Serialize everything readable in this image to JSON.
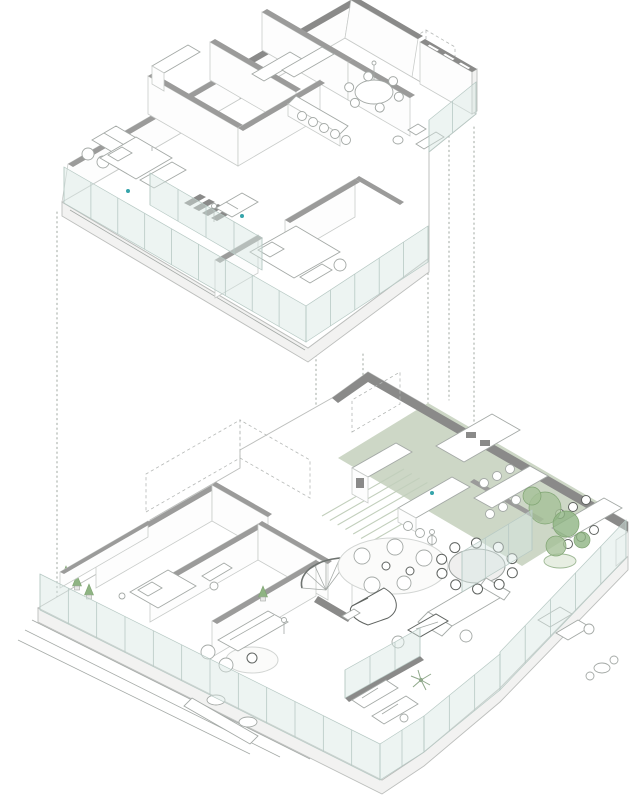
{
  "diagram": {
    "type": "exploded-axonometric-floor-plans",
    "floor_count": 2,
    "floors": [
      {
        "id": "upper-floor",
        "contents": [
          "bedroom with sofa and bed",
          "second bedroom",
          "master bedroom with bench",
          "bathroom",
          "kitchen with bar counter and five stools",
          "round dining table with chairs",
          "wardrobe cabinets",
          "stair opening with dark treads",
          "window-bay parapet wall",
          "perimeter glass walls"
        ]
      },
      {
        "id": "lower-floor",
        "contents": [
          "green roof strip with pergola slats",
          "kitchen with tall cabinets and island",
          "two long dining tables with chairs",
          "large round dining table with ten chairs",
          "winter-garden trees in planter",
          "lounge with round rug and armchairs",
          "grand piano",
          "curved staircase",
          "main sofa with dark coffee table",
          "left-wing bedroom",
          "left-wing living room",
          "terrace with sun loungers and palm",
          "terrace bar counter with round tables",
          "potted plants",
          "glass balustrades",
          "perimeter steps"
        ]
      }
    ]
  },
  "colors": {
    "bg": "#ffffff",
    "line": "#bdbfbd",
    "furn": "#a4a9a6",
    "slab_side": "#f2f2f1",
    "wall_cap": "#9b9b9a",
    "wall_cap_dark": "#8a8a89",
    "glass": "#d8e6e2",
    "green_roof": "#cdd7c6",
    "plant": "#a5c197",
    "plant_dark": "#8fb483",
    "plant_edge": "#7fa472",
    "accent_teal": "#35a4aa",
    "dotted_line": "#a0a8a2"
  },
  "projection_lines": [
    {
      "x": 57,
      "y1": 212,
      "y2": 597
    },
    {
      "x": 316,
      "y1": 350,
      "y2": 455
    },
    {
      "x": 363,
      "y1": 354,
      "y2": 446
    },
    {
      "x": 428,
      "y1": 206,
      "y2": 448
    },
    {
      "x": 449,
      "y1": 131,
      "y2": 400
    },
    {
      "x": 474,
      "y1": 127,
      "y2": 560
    }
  ],
  "glass_bands": [
    {
      "target": "glass-upper",
      "x1": 64,
      "y1": 203,
      "x2": 306,
      "y2": 342,
      "h": 36,
      "posts": 9
    },
    {
      "target": "glass-upper",
      "x1": 306,
      "y1": 342,
      "x2": 428,
      "y2": 262,
      "h": 36,
      "posts": 5
    },
    {
      "target": "glass-upper",
      "x1": 150,
      "y1": 205,
      "x2": 262,
      "y2": 270,
      "h": 32,
      "posts": 4
    },
    {
      "target": "glass-upper",
      "x1": 476,
      "y1": 114,
      "x2": 429,
      "y2": 152,
      "h": 32,
      "posts": 2
    },
    {
      "target": "glass-lower",
      "x1": 40,
      "y1": 610,
      "x2": 380,
      "y2": 780,
      "h": 36,
      "posts": 12
    },
    {
      "target": "glass-lower",
      "x1": 380,
      "y1": 780,
      "x2": 424,
      "y2": 752,
      "h": 36,
      "posts": 2
    },
    {
      "target": "glass-lower",
      "x1": 424,
      "y1": 752,
      "x2": 500,
      "y2": 690,
      "h": 36,
      "posts": 3
    },
    {
      "target": "glass-lower",
      "x1": 500,
      "y1": 690,
      "x2": 626,
      "y2": 558,
      "h": 38,
      "posts": 5
    },
    {
      "target": "glass-lower",
      "x1": 462,
      "y1": 592,
      "x2": 532,
      "y2": 550,
      "h": 40,
      "posts": 3
    },
    {
      "target": "glass-lower",
      "x1": 345,
      "y1": 698,
      "x2": 420,
      "y2": 656,
      "h": 28,
      "posts": 3
    }
  ],
  "plants": [
    {
      "x": 66,
      "y": 578
    },
    {
      "x": 77,
      "y": 587
    },
    {
      "x": 89,
      "y": 596
    },
    {
      "x": 263,
      "y": 598
    }
  ],
  "trees": [
    {
      "cx": 545,
      "cy": 508,
      "r": 16,
      "c": "plant"
    },
    {
      "cx": 566,
      "cy": 524,
      "r": 13,
      "c": "plant_dark"
    },
    {
      "cx": 556,
      "cy": 546,
      "r": 10,
      "c": "plant"
    },
    {
      "cx": 582,
      "cy": 540,
      "r": 8,
      "c": "plant_dark"
    },
    {
      "cx": 532,
      "cy": 496,
      "r": 9,
      "c": "plant"
    }
  ],
  "chair_rings": [
    {
      "cx": 374,
      "cy": 92,
      "rx": 26,
      "ry": 16,
      "n": 6,
      "r": 4.5,
      "dark": false,
      "target": "upper-furniture"
    },
    {
      "cx": 477,
      "cy": 566,
      "rx": 37,
      "ry": 23,
      "n": 10,
      "r": 5,
      "dark": true,
      "target": "lower-furniture"
    }
  ]
}
